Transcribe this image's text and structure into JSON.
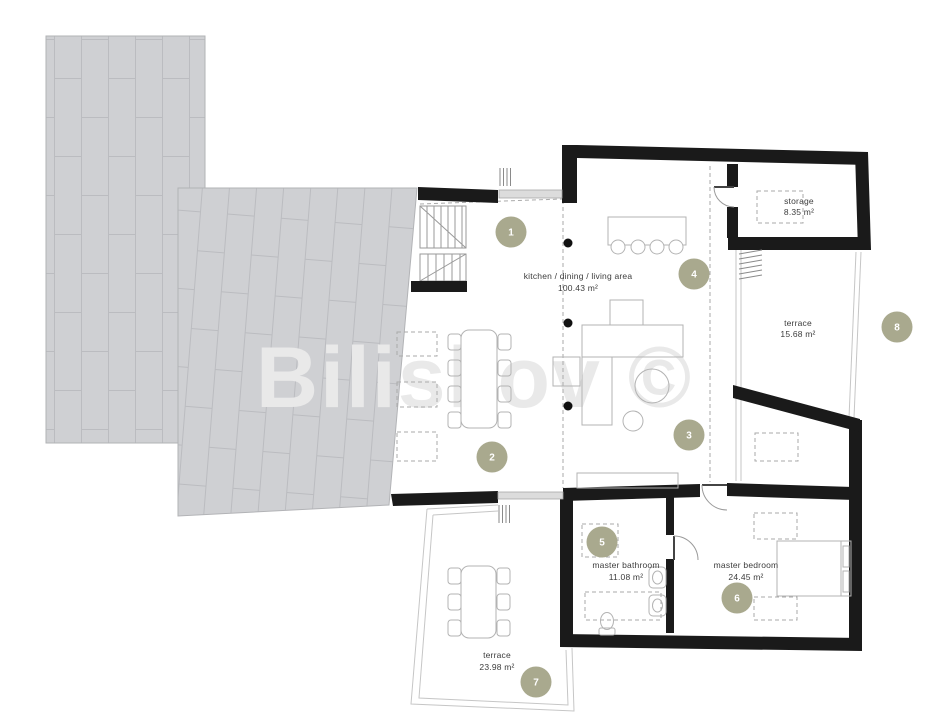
{
  "watermark": "Biliskov ©",
  "colors": {
    "badge": "#a9a98e",
    "wall": "#1a1a1a",
    "roof_tile": "#cfd0d3",
    "roof_joint": "#bbbcc0",
    "watermark": "#e9e9e9"
  },
  "rooms": [
    {
      "name": "kitchen / dining / living area",
      "area": "100.43 m²"
    },
    {
      "name": "storage",
      "area": "8.35 m²"
    },
    {
      "name": "terrace",
      "area": "15.68 m²"
    },
    {
      "name": "master bathroom",
      "area": "11.08 m²"
    },
    {
      "name": "master bedroom",
      "area": "24.45 m²"
    },
    {
      "name": "terrace",
      "area": "23.98 m²"
    }
  ],
  "badges": [
    "1",
    "2",
    "3",
    "4",
    "5",
    "6",
    "7",
    "8"
  ]
}
